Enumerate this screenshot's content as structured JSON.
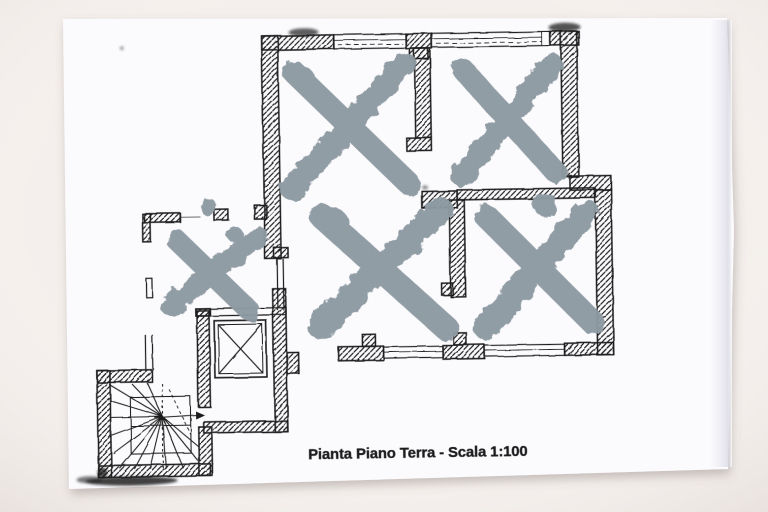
{
  "plan": {
    "caption": "Pianta Piano Terra - Scala 1:100",
    "x_mark_count": 5
  },
  "colors": {
    "background": "#f4efec",
    "paper": "#fbfafd",
    "ink": "#1c1c1c",
    "pencil": "#6a6a6a",
    "x_mark": "#8d99a2"
  }
}
